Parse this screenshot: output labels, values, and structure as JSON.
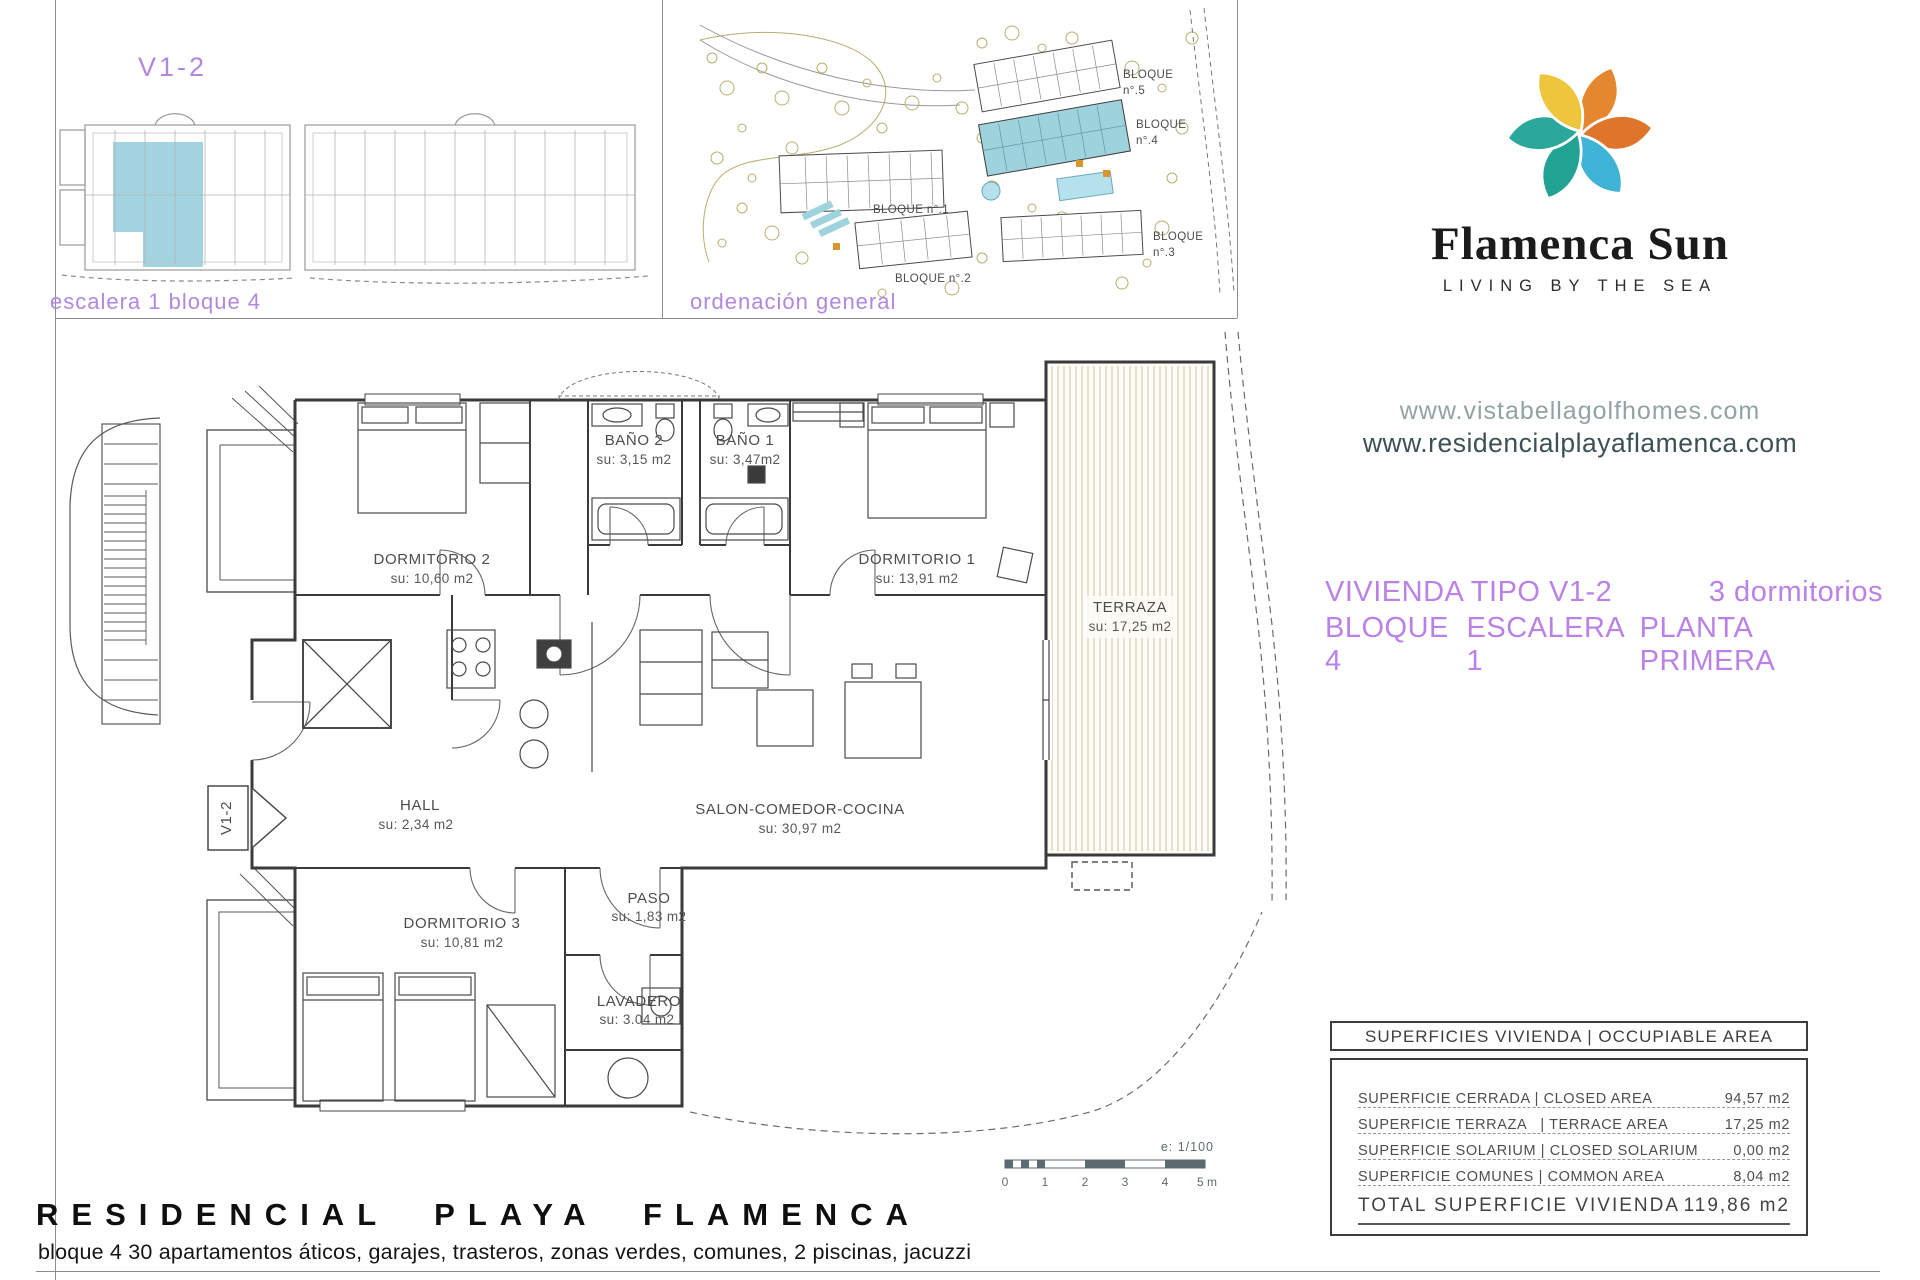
{
  "top_left": {
    "type_label": "V1-2",
    "caption": "escalera 1 bloque 4"
  },
  "site_plan": {
    "caption": "ordenación general",
    "blocks": [
      {
        "label": "BLOQUE",
        "num": "n°.5"
      },
      {
        "label": "BLOQUE",
        "num": "n°.4"
      },
      {
        "label": "BLOQUE",
        "num": "n°.3"
      },
      {
        "label": "BLOQUE n°.2"
      },
      {
        "label": "BLOQUE n°.1"
      }
    ]
  },
  "brand": {
    "name": "Flamenca Sun",
    "tagline": "LIVING BY THE SEA",
    "logo_colors": {
      "orange": "#e5872f",
      "dark_orange": "#df752a",
      "yellow": "#eec63e",
      "teal": "#21a292",
      "green_teal": "#2aa89b",
      "blue": "#3eb3d6"
    }
  },
  "urls": {
    "primary": "www.vistabellagolfhomes.com",
    "secondary": "www.residencialplayaflamenca.com"
  },
  "unit_info": {
    "type": "VIVIENDA TIPO V1-2",
    "bedrooms": "3 dormitorios",
    "block": "BLOQUE 4",
    "stair": "ESCALERA 1",
    "floor": "PLANTA PRIMERA"
  },
  "floor_plan": {
    "entrance_label": "V1-2",
    "highlight_color": "#9dd1df",
    "rooms": {
      "dormitorio2": {
        "name": "DORMITORIO 2",
        "area": "su: 10,60 m2"
      },
      "bano2": {
        "name": "BAÑO 2",
        "area": "su: 3,15 m2"
      },
      "bano1": {
        "name": "BAÑO 1",
        "area": "su: 3,47m2"
      },
      "dormitorio1": {
        "name": "DORMITORIO 1",
        "area": "su: 13,91 m2"
      },
      "terraza": {
        "name": "TERRAZA",
        "area": "su: 17,25 m2"
      },
      "hall": {
        "name": "HALL",
        "area": "su: 2,34 m2"
      },
      "salon": {
        "name": "SALON-COMEDOR-COCINA",
        "area": "su: 30,97 m2"
      },
      "dormitorio3": {
        "name": "DORMITORIO 3",
        "area": "su: 10,81 m2"
      },
      "paso": {
        "name": "PASO",
        "area": "su: 1,83 m2"
      },
      "lavadero": {
        "name": "LAVADERO",
        "area": "su: 3.04 m2"
      }
    },
    "scale": {
      "label": "e: 1/100",
      "ticks": [
        "0",
        "1",
        "2",
        "3",
        "4",
        "5 m"
      ]
    }
  },
  "areas_table": {
    "header": "SUPERFICIES VIVIENDA | OCCUPIABLE AREA",
    "rows": [
      {
        "label": "SUPERFICIE CERRADA | CLOSED AREA",
        "value": "94,57 m2"
      },
      {
        "label": "SUPERFICIE TERRAZA   | TERRACE AREA",
        "value": "17,25 m2"
      },
      {
        "label": "SUPERFICIE SOLARIUM | CLOSED SOLARIUM",
        "value": "0,00 m2"
      },
      {
        "label": "SUPERFICIE COMUNES | COMMON AREA",
        "value": "8,04 m2"
      }
    ],
    "total": {
      "label": "TOTAL SUPERFICIE VIVIENDA",
      "value": "119,86 m2"
    }
  },
  "footer": {
    "title": "RESIDENCIAL PLAYA FLAMENCA",
    "subtitle": "bloque 4 30 apartamentos áticos, garajes, trasteros, zonas verdes, comunes, 2 piscinas, jacuzzi"
  }
}
